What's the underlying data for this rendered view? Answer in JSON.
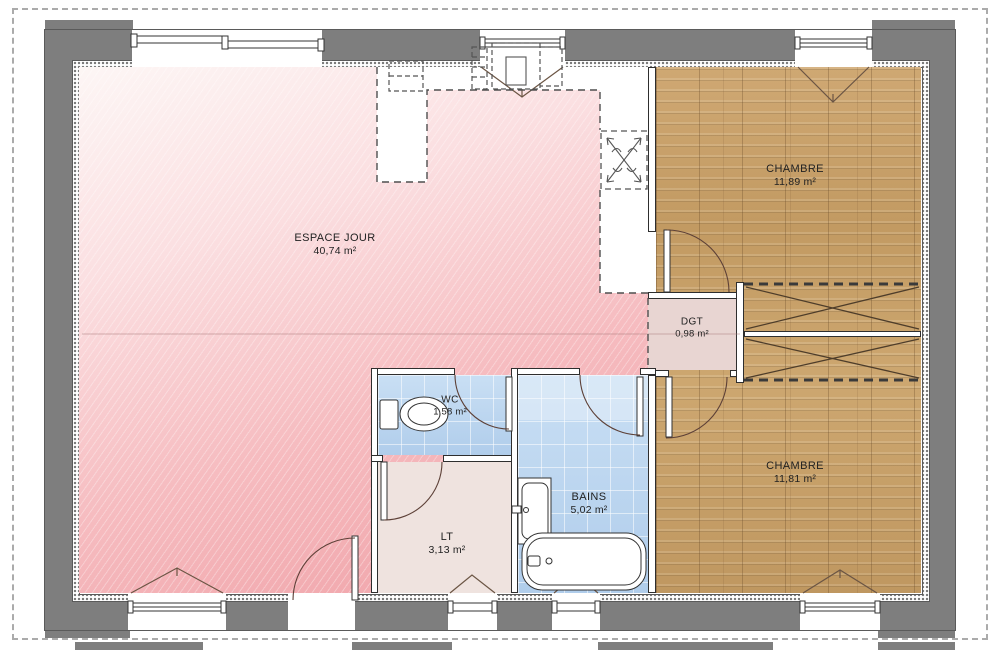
{
  "plan": {
    "type": "house-floor-plan",
    "units": "m²"
  },
  "rooms": [
    {
      "name": "ESPACE JOUR",
      "area": "40,74 m²"
    },
    {
      "name": "CHAMBRE",
      "area": "11,89 m²"
    },
    {
      "name": "DGT",
      "area": "0,98 m²"
    },
    {
      "name": "CHAMBRE",
      "area": "11,81 m²"
    },
    {
      "name": "WC",
      "area": "1,58 m²"
    },
    {
      "name": "BAINS",
      "area": "5,02 m²"
    },
    {
      "name": "LT",
      "area": "3,13 m²"
    }
  ],
  "fixtures": [
    "bathtub",
    "toilet",
    "washbasin",
    "wardrobe-cross",
    "kitchen-units-dashed",
    "water-heater-dashed"
  ],
  "colors": {
    "exterior_wall": "#7e7e7e",
    "wood_floor": "#c8a36c",
    "tile_blue": "#b9d3ee",
    "living_pink": "#ef9fa5",
    "dgt_fill": "#e8d5d2",
    "lt_fill": "#efe3df"
  }
}
